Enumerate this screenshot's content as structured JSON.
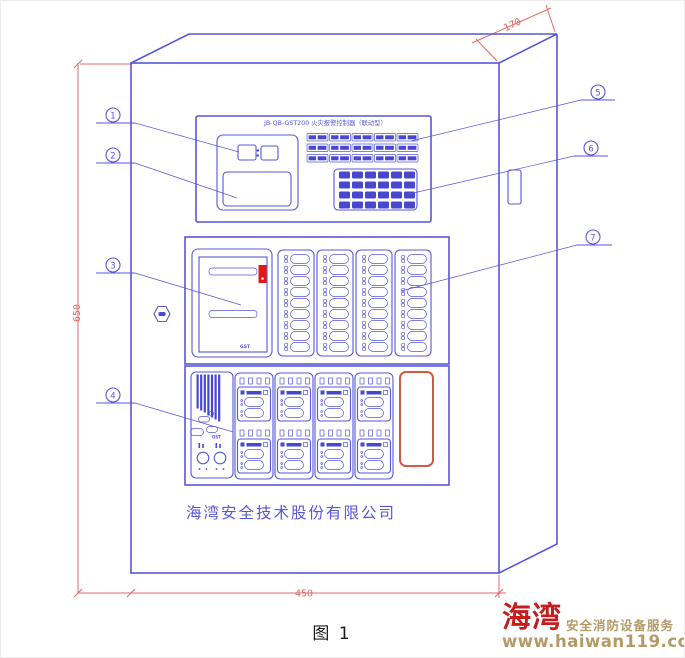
{
  "figure": {
    "caption": "图 1"
  },
  "device": {
    "model_title": "JB-QB-GST200 火灾报警控制器（联动型）",
    "company": "海湾安全技术股份有限公司",
    "printer_logo": "GST",
    "mic_logo": "GST"
  },
  "dimensions": {
    "depth": "170",
    "height": "650",
    "width": "450"
  },
  "callouts": {
    "left": [
      "1",
      "2",
      "3",
      "4"
    ],
    "right": [
      "5",
      "6",
      "7"
    ]
  },
  "brand_footer": {
    "brand": "海湾",
    "tagline": "安全消防设备服务",
    "url": "www.haiwan119.com"
  },
  "colors": {
    "line": "#5757d8",
    "line_strong": "#4747cf",
    "dim": "#e06a6a",
    "alarm_red": "#e81515",
    "zone_red": "#d05a45",
    "brand_red": "#c41e1e",
    "brand_tan": "#b39a67"
  }
}
